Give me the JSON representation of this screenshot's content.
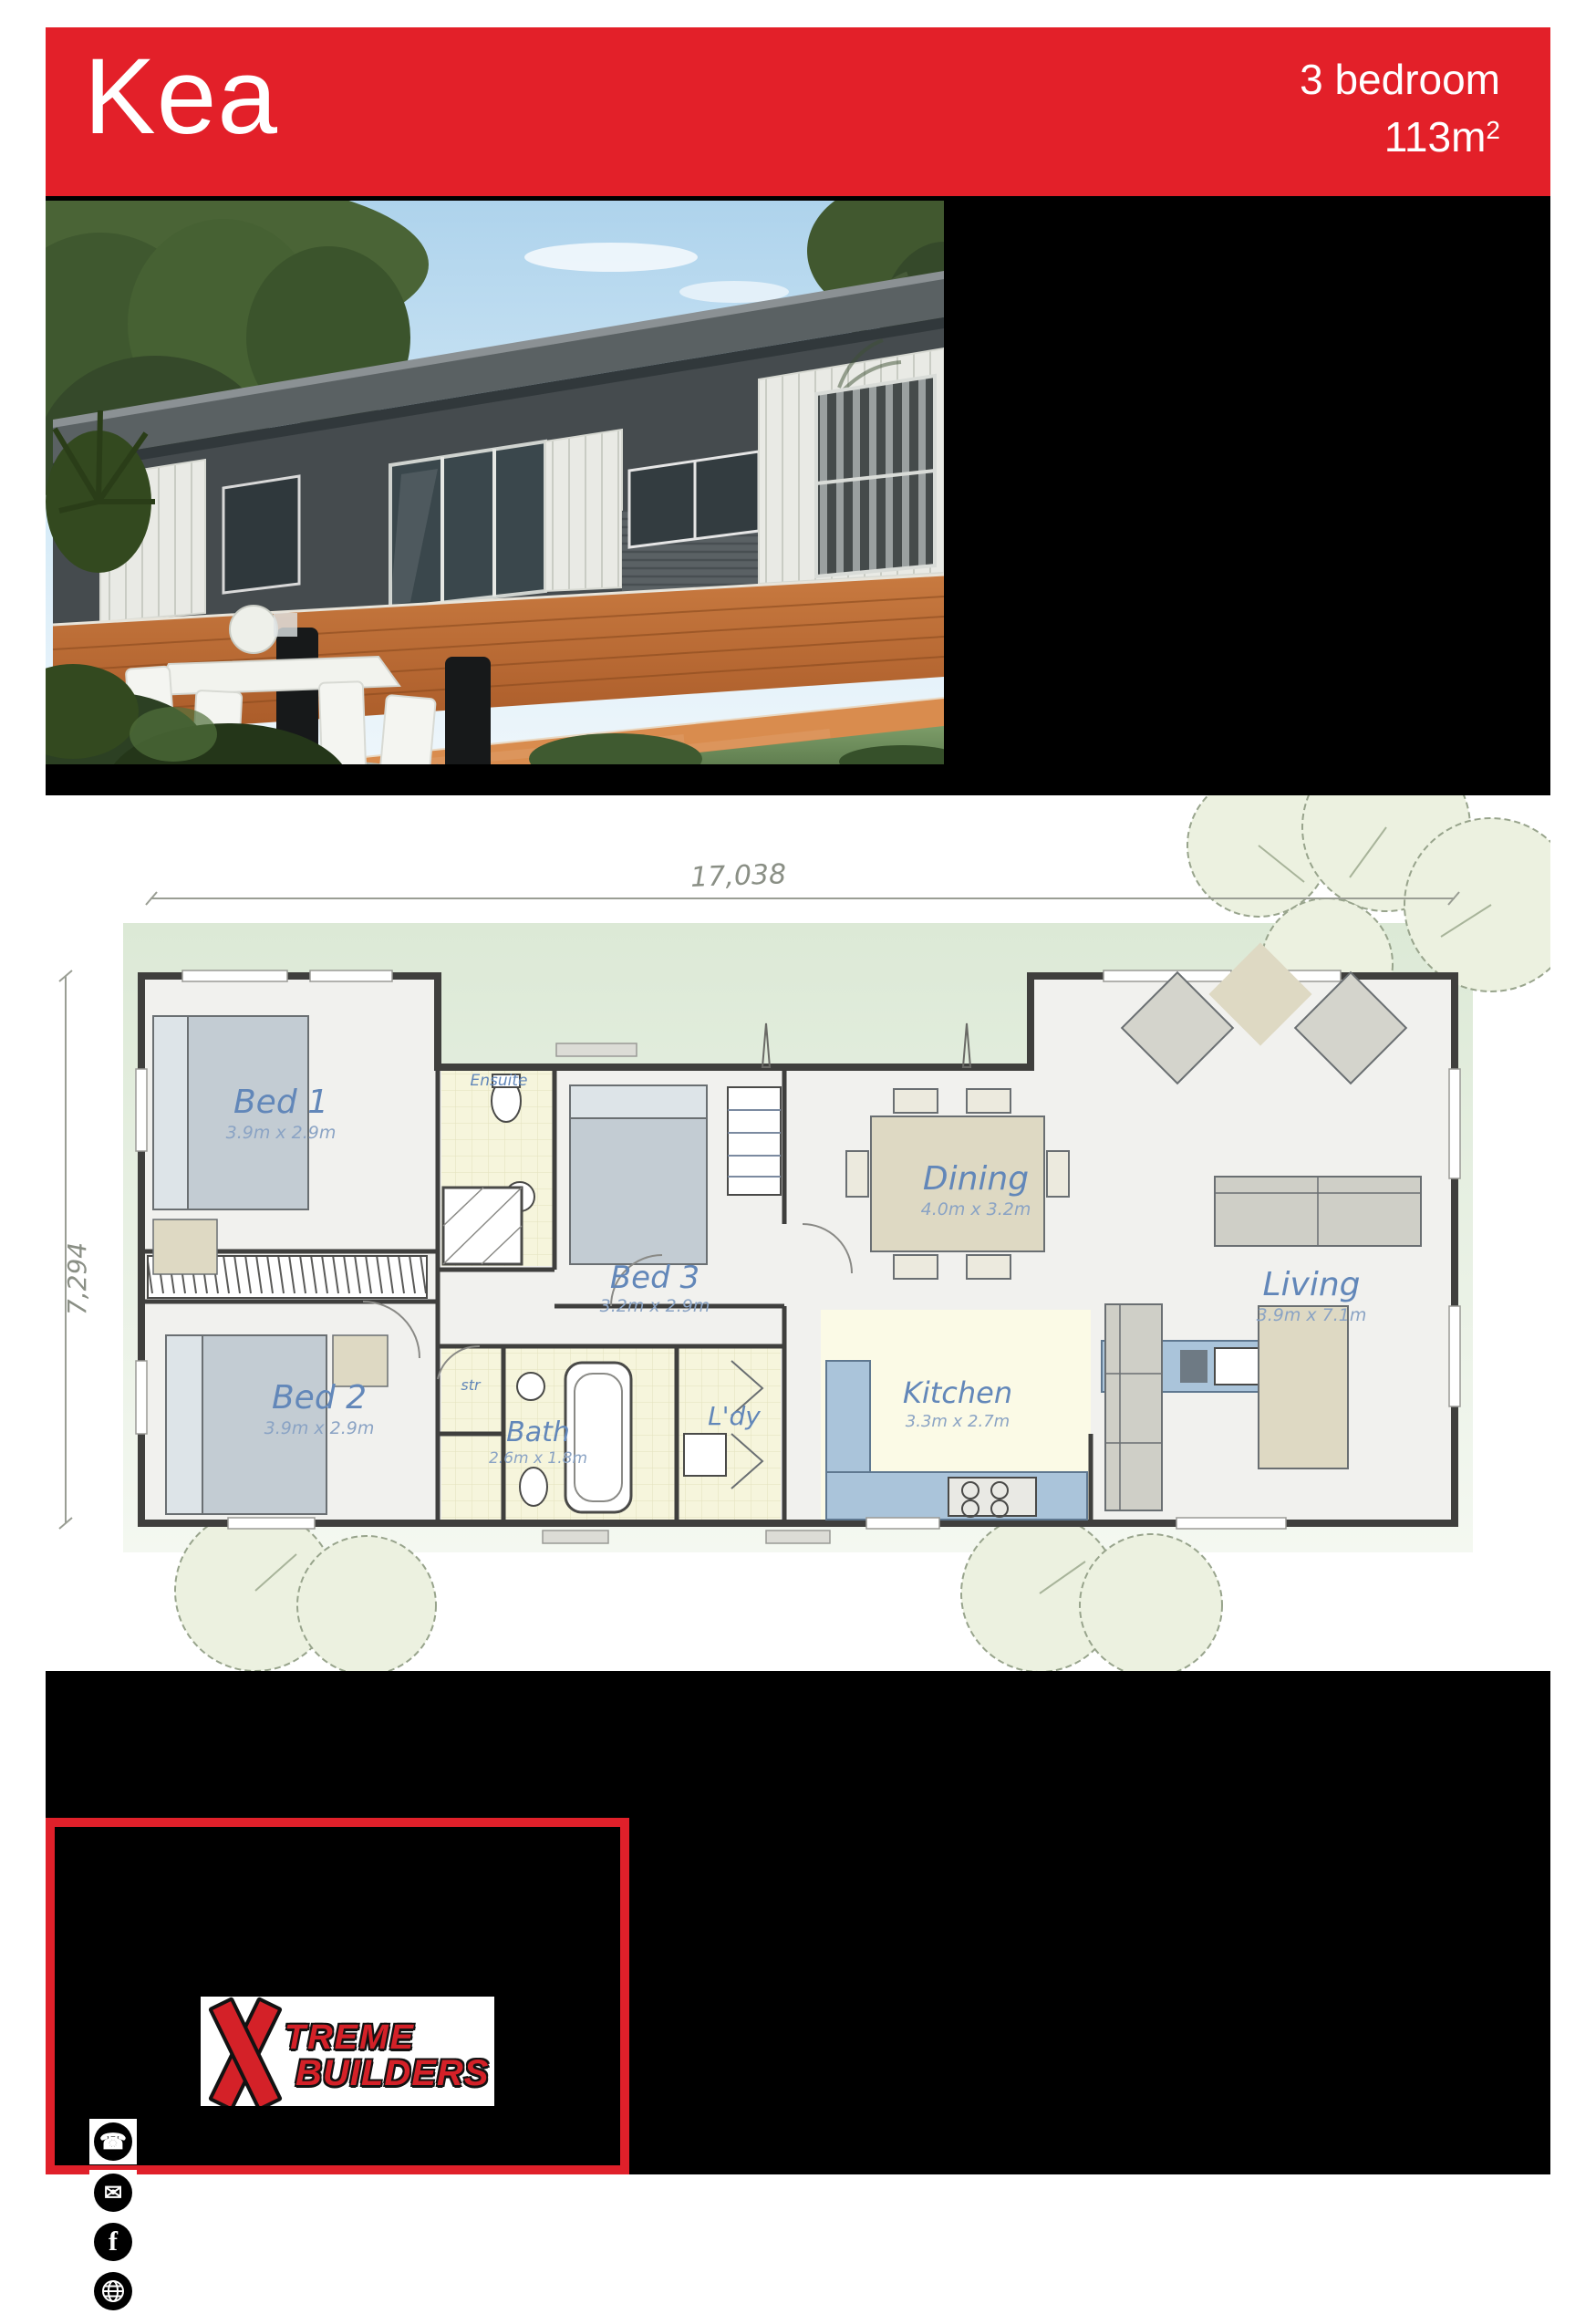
{
  "header": {
    "title": "Kea",
    "spec_line1": "3 bedroom",
    "area_value": "113m",
    "area_sup": "2",
    "bg_color": "#e32029"
  },
  "plan": {
    "overall_width_label": "17,038",
    "overall_depth_label": "7,294",
    "label_color": "#6287b9",
    "rooms": [
      {
        "name": "Bed 1",
        "dims": "3.9m x 2.9m"
      },
      {
        "name": "Ensuite",
        "dims": ""
      },
      {
        "name": "Bed 3",
        "dims": "3.2m x 2.9m"
      },
      {
        "name": "Bed 2",
        "dims": "3.9m x 2.9m"
      },
      {
        "name": "str",
        "dims": ""
      },
      {
        "name": "Bath",
        "dims": "2.6m x 1.8m"
      },
      {
        "name": "L'dy",
        "dims": ""
      },
      {
        "name": "Kitchen",
        "dims": "3.3m x 2.7m"
      },
      {
        "name": "Dining",
        "dims": "4.0m x 3.2m"
      },
      {
        "name": "Living",
        "dims": "3.9m x 7.1m"
      }
    ]
  },
  "footer": {
    "logo_x": "X",
    "logo_line1": "TREME",
    "logo_line2": "BUILDERS",
    "accent_color": "#e0202a",
    "icons": [
      "phone-icon",
      "email-icon",
      "facebook-icon",
      "globe-icon"
    ],
    "phone_glyph": "☎",
    "email_glyph": "✉",
    "facebook_glyph": "f"
  }
}
